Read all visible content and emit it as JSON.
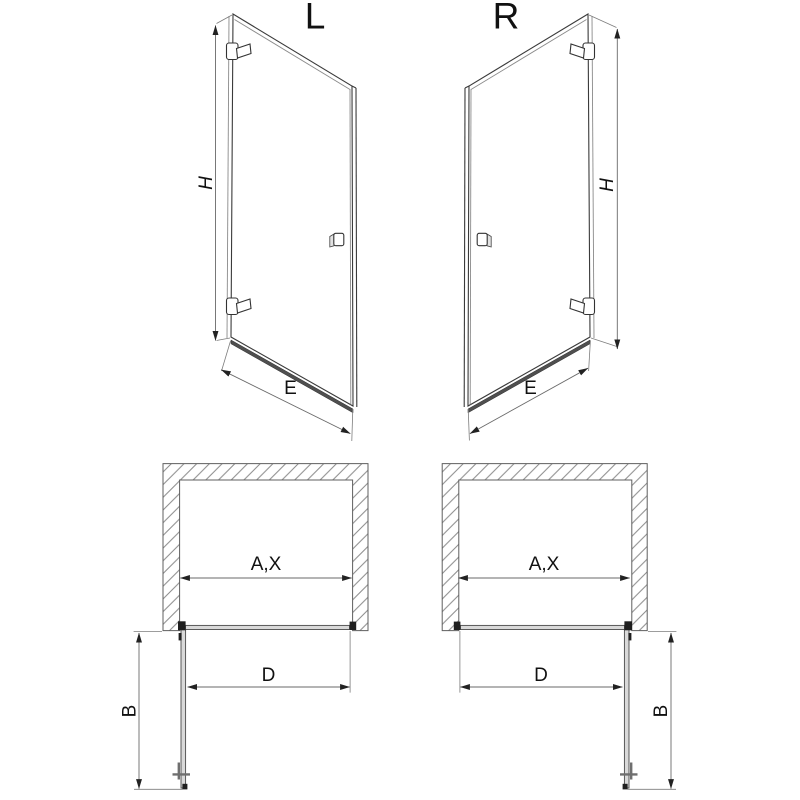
{
  "page": {
    "background_color": "#ffffff"
  },
  "colors": {
    "drawing_line": "#3a3a3a",
    "dimension_line": "#6a6a6a",
    "wall_line": "#5f5f5f",
    "wall_hatch": "#8a8a8a",
    "panel_fill": "#d9d9d9",
    "rail_fill": "#4f4f4f",
    "hardware_fill": "#1f1f1f",
    "text": "#111111"
  },
  "elevation_left": {
    "title": "L",
    "height_dim_label": "H",
    "width_dim_label": "E"
  },
  "elevation_right": {
    "title": "R",
    "height_dim_label": "H",
    "width_dim_label": "E"
  },
  "plan_left": {
    "opening_dim_label": "A,X",
    "door_width_dim_label": "D",
    "swing_depth_dim_label": "B"
  },
  "plan_right": {
    "opening_dim_label": "A,X",
    "door_width_dim_label": "D",
    "swing_depth_dim_label": "B"
  }
}
